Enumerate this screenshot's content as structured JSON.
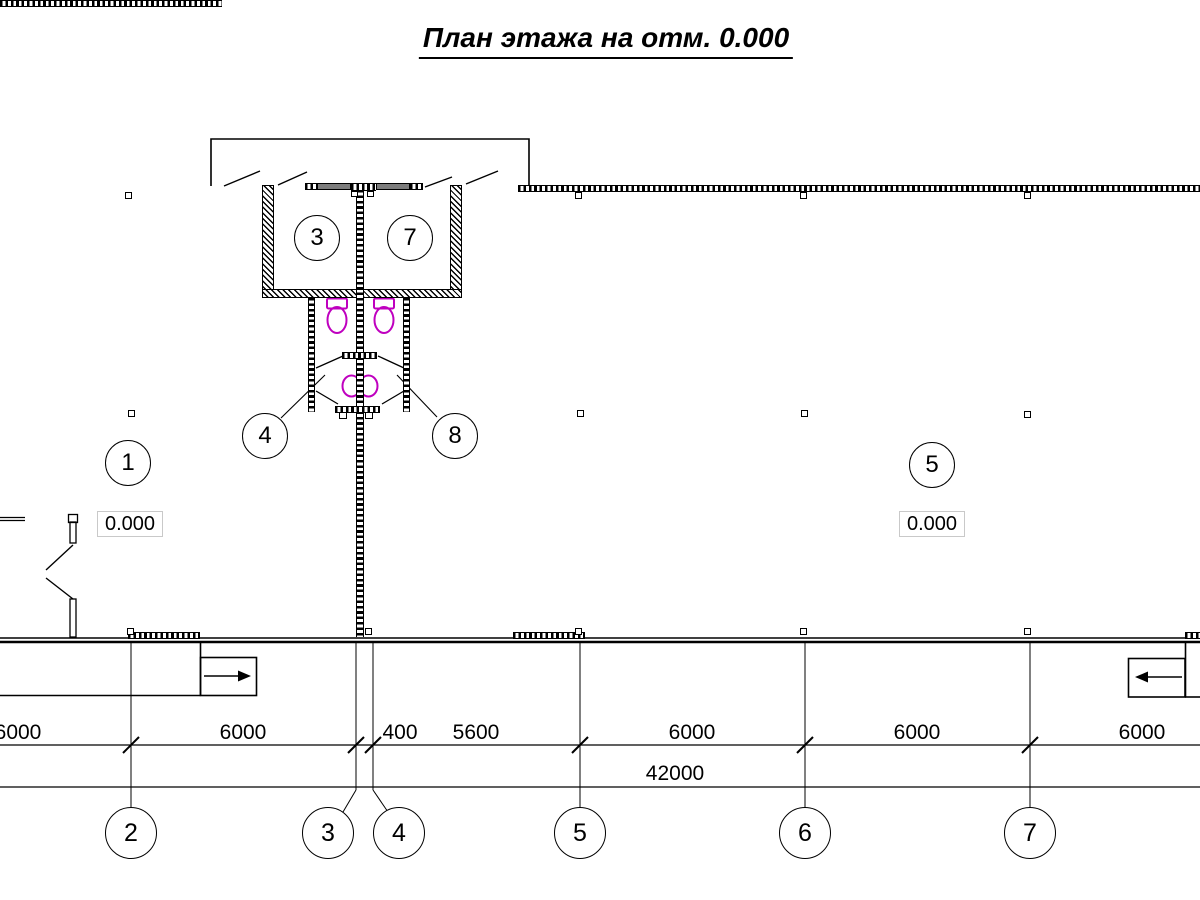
{
  "title": "План этажа на отм. 0.000",
  "room_labels": {
    "hall_left": "1",
    "wc_left": "3",
    "lobby_left": "4",
    "hall_right": "5",
    "wc_right": "7",
    "lobby_right": "8"
  },
  "elevations": {
    "left": "0.000",
    "right": "0.000"
  },
  "dimensions": {
    "row1": [
      "6000",
      "6000",
      "400",
      "5600",
      "6000",
      "6000",
      "6000"
    ],
    "total": "42000"
  },
  "axes": [
    "2",
    "3",
    "4",
    "5",
    "6",
    "7"
  ],
  "colors": {
    "fixture": "#bf00bf",
    "wall": "#000000",
    "partition": "#7d7d7d"
  }
}
